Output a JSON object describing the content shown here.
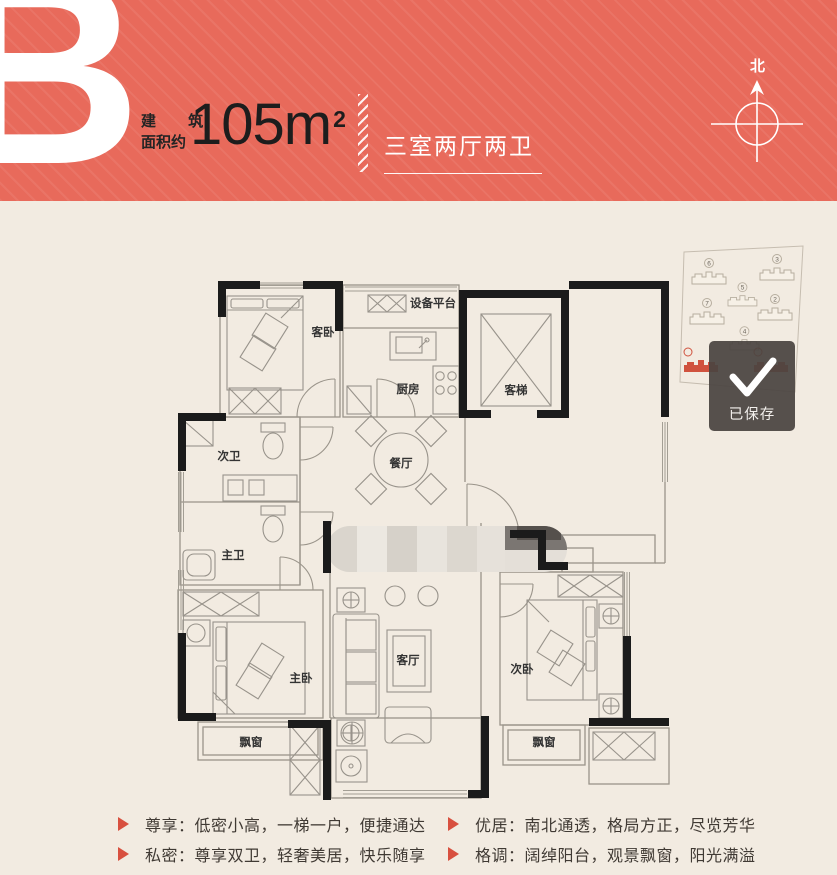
{
  "header": {
    "plan_letter": "B",
    "area_label_line1": "建 筑",
    "area_label_line2": "面积约",
    "area_value": "105m",
    "area_exponent": "2",
    "layout_summary": "三室两厅两卫",
    "compass_label": "北"
  },
  "floorplan": {
    "rooms": {
      "guest_bedroom": "客卧",
      "equipment_platform": "设备平台",
      "kitchen": "厨房",
      "elevator": "客梯",
      "second_bathroom": "次卫",
      "dining_room": "餐厅",
      "master_bathroom": "主卫",
      "master_bedroom": "主卧",
      "living_room": "客厅",
      "second_bedroom": "次卧",
      "bay_window_left": "飘窗",
      "bay_window_right": "飘窗"
    }
  },
  "site_plan": {
    "building_numbers": [
      "6",
      "3",
      "5",
      "7",
      "2",
      "4"
    ],
    "highlight_numbers": [
      "",
      ""
    ]
  },
  "toast": {
    "message": "已保存"
  },
  "features": [
    {
      "text": "尊享：低密小高，一梯一户，便捷通达"
    },
    {
      "text": "私密：尊享双卫，轻奢美居，快乐随享"
    },
    {
      "text": "优居：南北通透，格局方正，尽览芳华"
    },
    {
      "text": "格调：阔绰阳台，观景飘窗，阳光满溢"
    }
  ],
  "colors": {
    "header_bg": "#e86a5b",
    "body_bg": "#f2ebe1",
    "accent_red": "#d8503f",
    "toast_bg": "#4a443f"
  }
}
